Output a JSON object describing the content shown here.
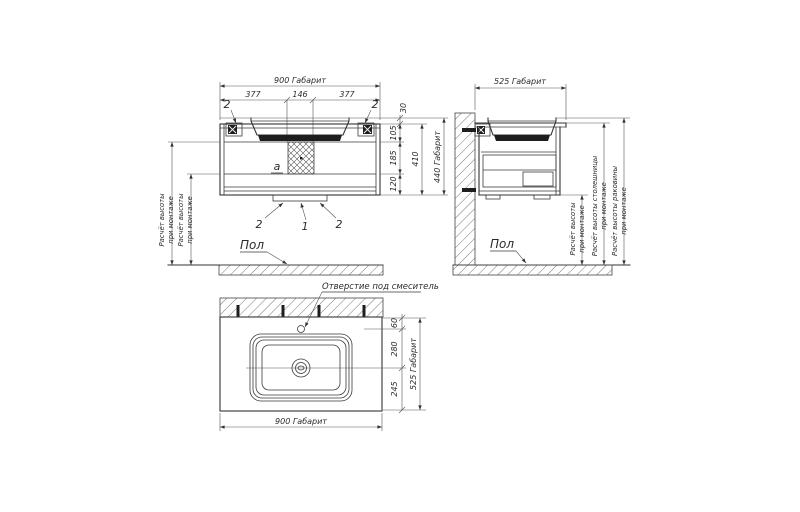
{
  "front": {
    "dim_overall": "900 Габарит",
    "dim_left": "377",
    "dim_center": "146",
    "dim_right": "377",
    "dim_rim_height": "30",
    "dim_top_section": "105",
    "dim_mid_section": "185",
    "dim_bottom_section": "120",
    "dim_body_height": "410",
    "dim_height_overall": "440 Габарит",
    "pos_bracket_left": "2",
    "pos_bracket_right": "2",
    "pos_siphon": "a",
    "pos_rail_left": "2",
    "pos_rail_center": "1",
    "pos_rail_right": "2",
    "floor_label": "Пол",
    "note1_line1": "Расчёт высоты",
    "note1_line2": "при монтаже",
    "note2_line1": "Расчёт высоты",
    "note2_line2": "при монтаже"
  },
  "side": {
    "dim_overall": "525 Габарит",
    "floor_label": "Пол",
    "note_mount_line1": "Расчёт высоты",
    "note_mount_line2": "при монтаже",
    "note_countertop_line1": "Расчёт высоты столешницы",
    "note_countertop_line2": "при монтаже",
    "note_sink_line1": "Расчёт высоты раковины",
    "note_sink_line2": "при монтаже"
  },
  "top": {
    "faucet_label": "Отверстие под смеситель",
    "dim_faucet_offset": "60",
    "dim_drain_offset": "280",
    "dim_front_offset": "245",
    "dim_depth_overall": "525 Габарит",
    "dim_width_overall": "900 Габарит"
  },
  "colors": {
    "line": "#333333",
    "text": "#2b2b2b",
    "dark_fill": "#1e1e1e",
    "background": "#ffffff"
  }
}
